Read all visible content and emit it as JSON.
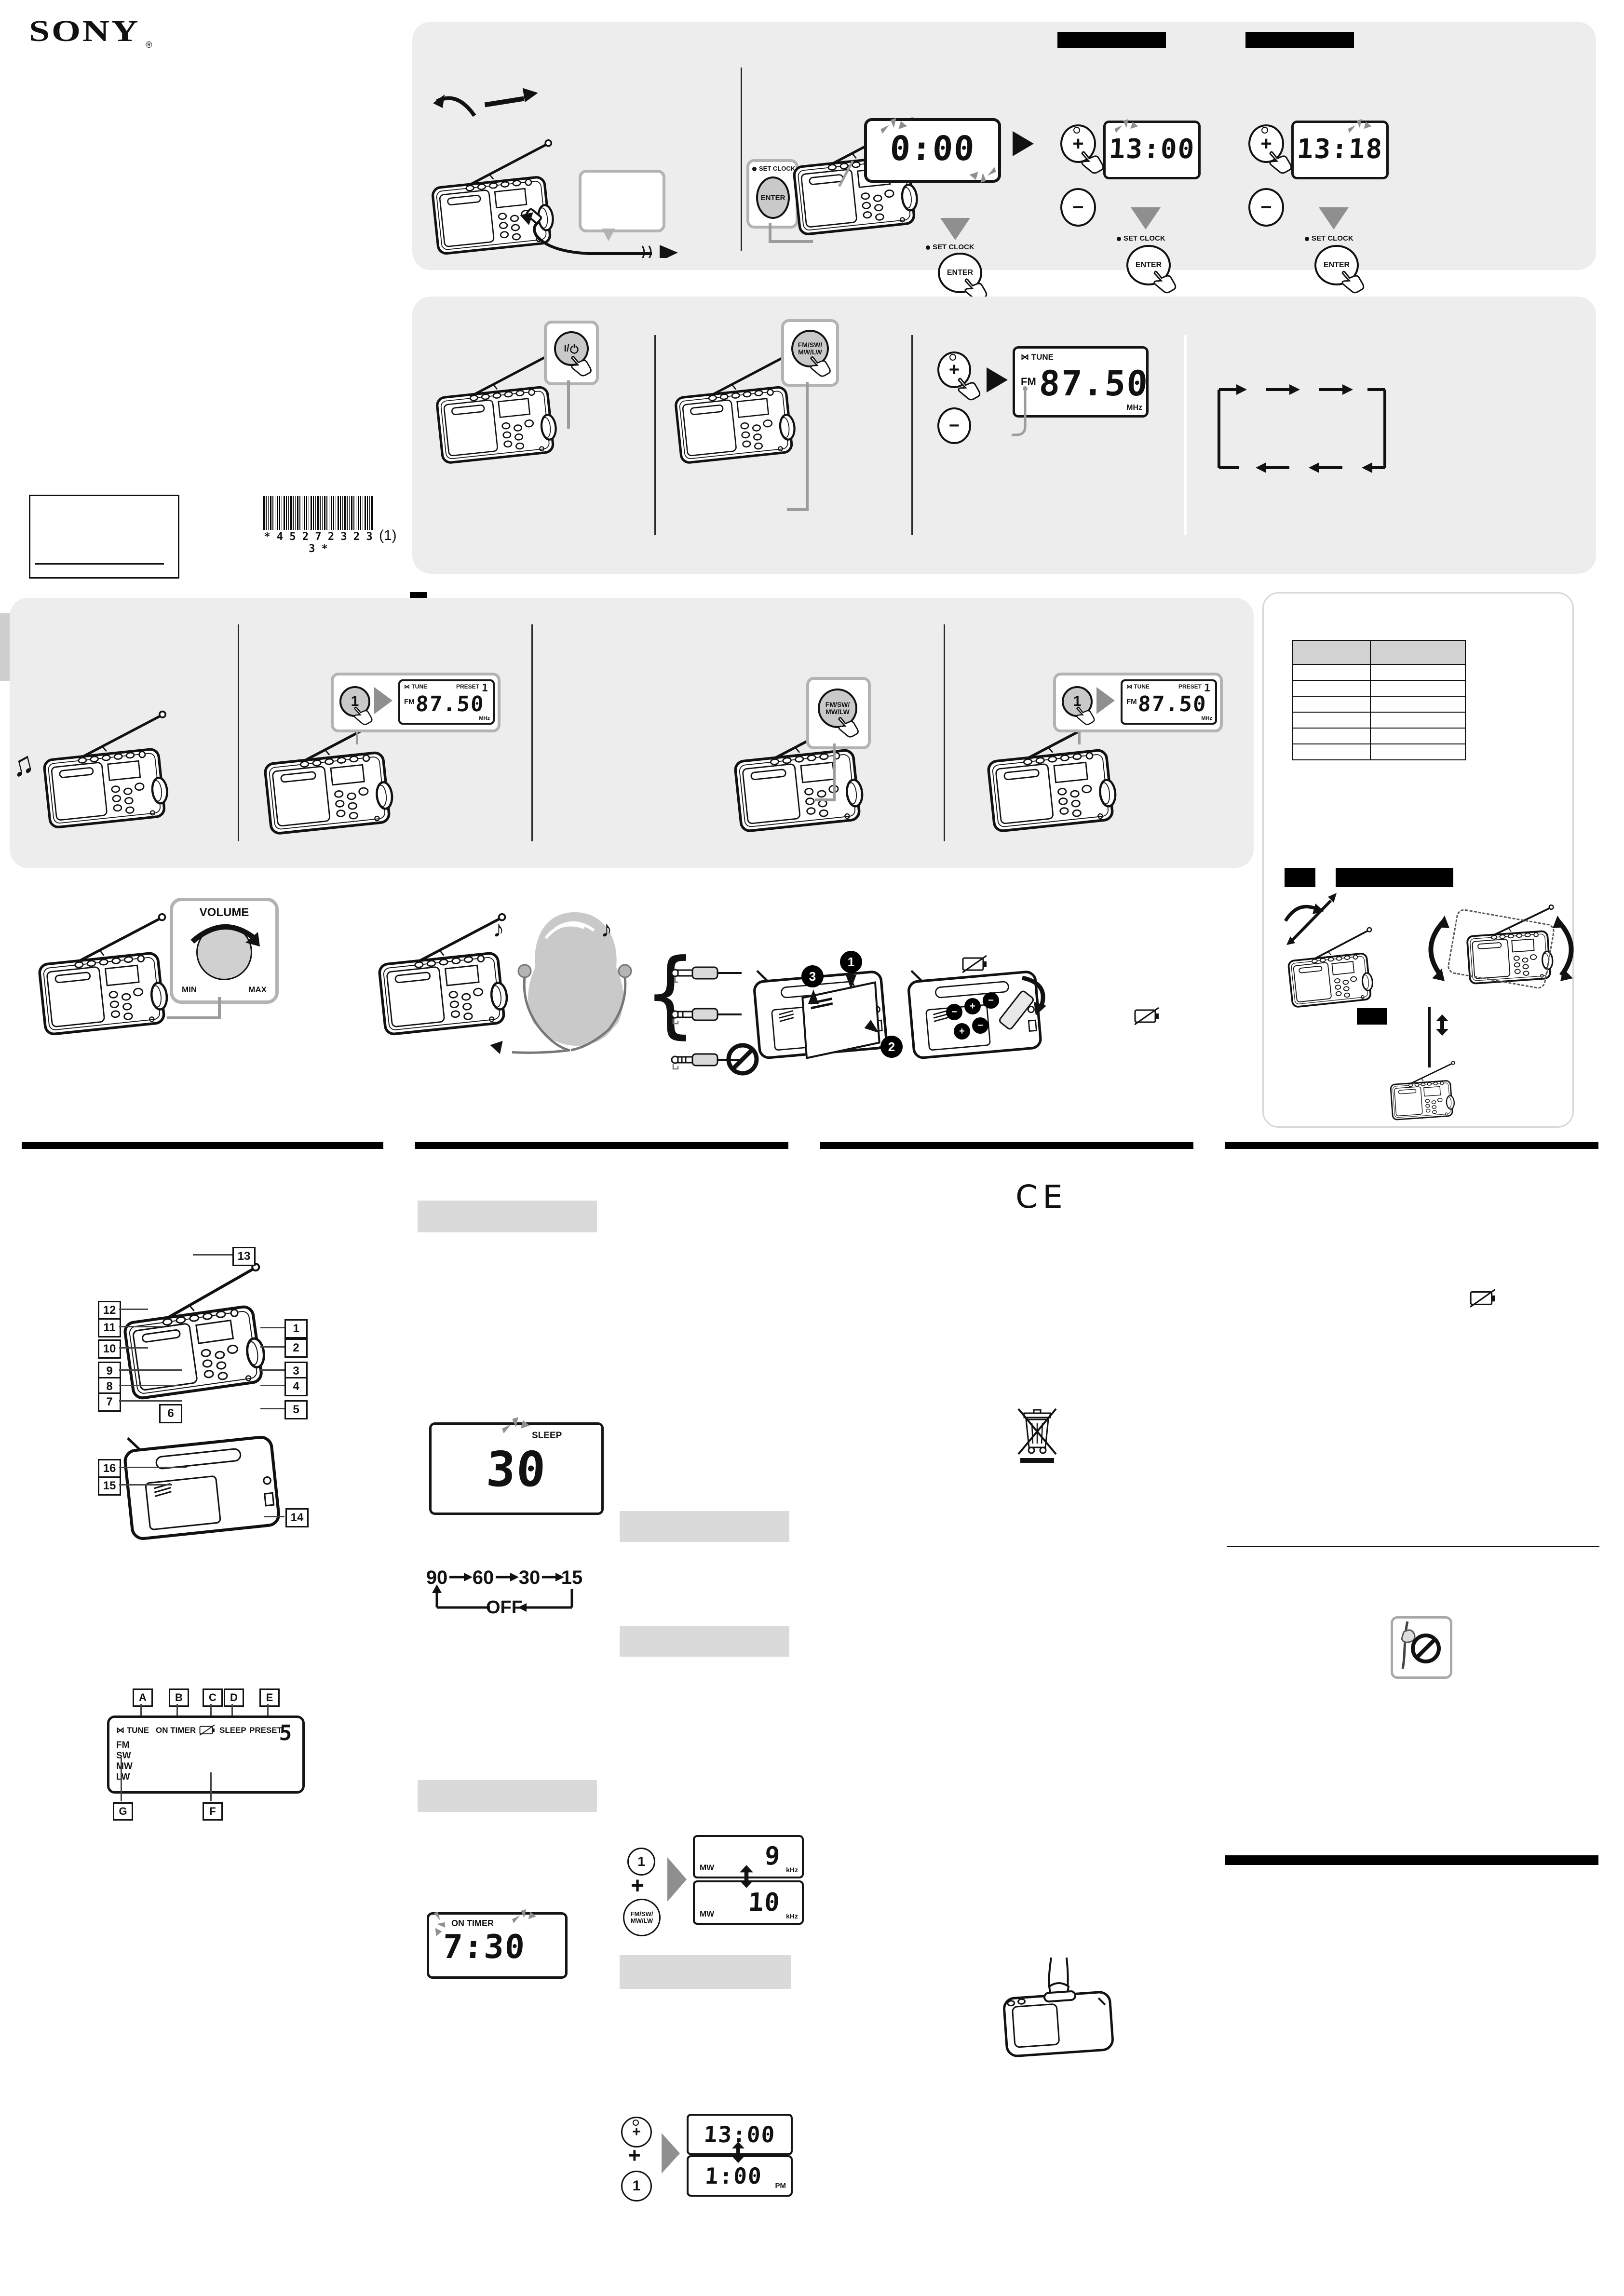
{
  "labels": {
    "sony": "SONY",
    "reg": "®",
    "set_clock": "SET CLOCK",
    "enter": "ENTER",
    "plus": "+",
    "minus": "−",
    "power_prefix": "I/",
    "band1": "FM/SW/",
    "band2": "MW/LW",
    "one": "1",
    "volume": "VOLUME",
    "min": "MIN",
    "max": "MAX",
    "off": "OFF",
    "pm": "PM",
    "mw": "MW",
    "fm": "FM",
    "khz": "kHz",
    "mhz": "MHz",
    "tune": "TUNE",
    "on_timer": "ON TIMER",
    "sleep": "SLEEP",
    "preset": "PRESET",
    "tune_mark": "⋈"
  },
  "lcd": {
    "initial": "0:00",
    "hour_set": "13:00",
    "minute_set": "13:18",
    "freq": "87.50",
    "preset_num": "1",
    "preset5": "5",
    "sleep_val": "30",
    "on_timer_val": "7:30",
    "step9": "9",
    "step10": "10",
    "t24": "13:00",
    "t12": "1:00"
  },
  "cycle": {
    "c90": "90",
    "c60": "60",
    "c30": "30",
    "c15": "15"
  },
  "barcode": {
    "text": "* 4 5 2 7 2 3 2 3 3 *",
    "suffix": "(1)"
  },
  "guide": {
    "nums": [
      "1",
      "2",
      "3",
      "4",
      "5",
      "6",
      "7",
      "8",
      "9",
      "10",
      "11",
      "12",
      "13",
      "14",
      "15",
      "16"
    ],
    "letters": [
      "A",
      "B",
      "C",
      "D",
      "E",
      "F",
      "G"
    ],
    "bands": [
      "FM",
      "SW",
      "MW",
      "LW"
    ]
  },
  "steps": {
    "s1": "1",
    "s2": "2",
    "s3": "3"
  },
  "ce": "CE",
  "colors": {
    "panel_gray": "#ededed",
    "header_bar_gray": "#dadada",
    "table_header": "#d2d2d2",
    "callout_border": "#b3b3b3",
    "arrow_gray": "#8f8f8f",
    "ink": "#111111",
    "model_band_gray": "#cfcfcf",
    "button_gray": "#c9c9c9"
  }
}
